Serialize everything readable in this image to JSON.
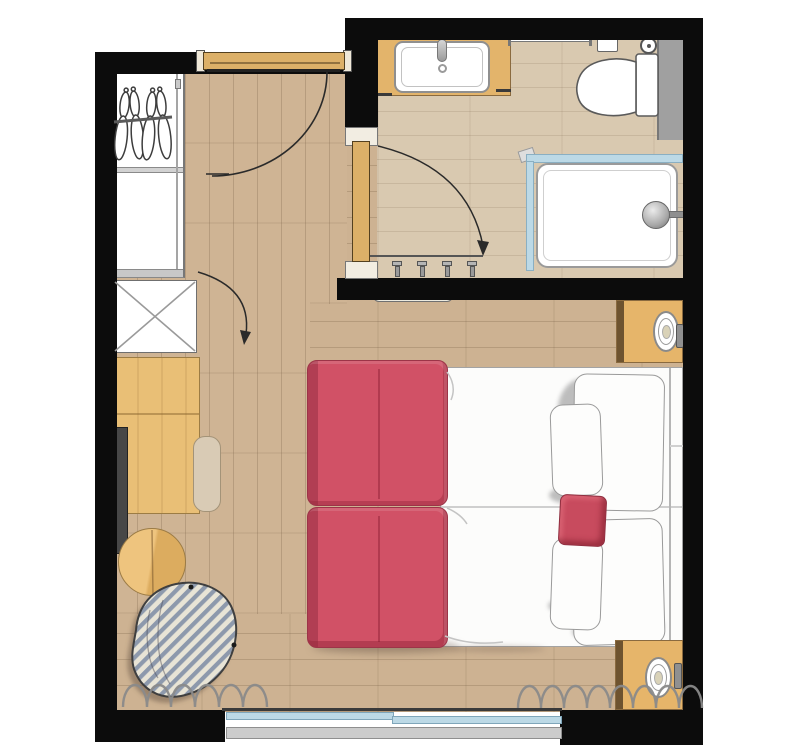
{
  "document": {
    "title": "Hotel guest room floor plan",
    "view": "top-down architectural plan",
    "rooms": [
      "Entry",
      "Bathroom",
      "Bedroom"
    ]
  },
  "palette": {
    "wall_black": "#0c0c0c",
    "floor_wood": "#cdb292",
    "floor_bathroom": "#d9c9b0",
    "furniture_wood": "#e6b56a",
    "door_wood": "#dcb068",
    "accent_red": "#d15166",
    "accent_red_dark": "#a73950",
    "glass_blue": "#bcd9e6",
    "partition_gray": "#a0a0a0",
    "sill_gray": "#cccccc",
    "curtain_gray": "#8a8a8a",
    "pouf_stripe_blue": "#8d99ac",
    "pouf_stripe_cream": "#e8e4d6"
  },
  "entry": {
    "door_label": "Entrance door with 90° swing arc",
    "wardrobe_label": "Open wardrobe with clothes rail and four hangers",
    "rail_label": "Clothes rail",
    "hanger_label": "Clothes hanger",
    "cabinet_label": "Luggage rack / cabinet (crossed) with door swing arrow"
  },
  "bathroom": {
    "label": "Bathroom",
    "door_label": "Bathroom door with swing arc arrow",
    "vanity_label": "Timber vanity with washbasin",
    "basin_label": "Washbasin",
    "faucet_label": "Faucet",
    "mirror_label": "Wall mirror",
    "towel_rail_label": "Towel rail",
    "flush_label": "Flush plate / tissue box",
    "tp_label": "Toilet-roll holder",
    "toilet_label": "Toilet",
    "partition_label": "Partition wall",
    "shower_label": "Walk-in shower tray",
    "glass_label": "Shower glass screen",
    "head_label": "Shower head",
    "hooks_label": "Four towel hooks"
  },
  "bedroom": {
    "label": "Bedroom",
    "bed_label": "Double bed (two mattresses) with headboard at right wall",
    "pillow_large_top_label": "Large pillow (upper)",
    "pillow_small_top_label": "Small pillow (upper)",
    "pillow_large_bottom_label": "Large pillow (lower)",
    "pillow_small_bottom_label": "Small pillow (lower)",
    "cushion_label": "Red accent cushion",
    "sofa_label": "Red two-cushion sofa bench at foot of bed",
    "nightstand_top_label": "Bedside table (upper) with lamp",
    "nightstand_bottom_label": "Bedside table (lower) with lamp",
    "lamp_label": "Table lamp",
    "switch_label": "Bedside switch",
    "desk_label": "Writing desk",
    "chair_label": "Desk chair seat",
    "tv_label": "Wall-mounted flat-screen TV",
    "side_table_label": "Round side table / stool",
    "pouf_label": "Striped pouf",
    "wall_art_label": "Wall-mounted picture / shelf",
    "curtain_label": "Curtain (scalloped symbol)",
    "window_label": "Sliding window with sill"
  }
}
